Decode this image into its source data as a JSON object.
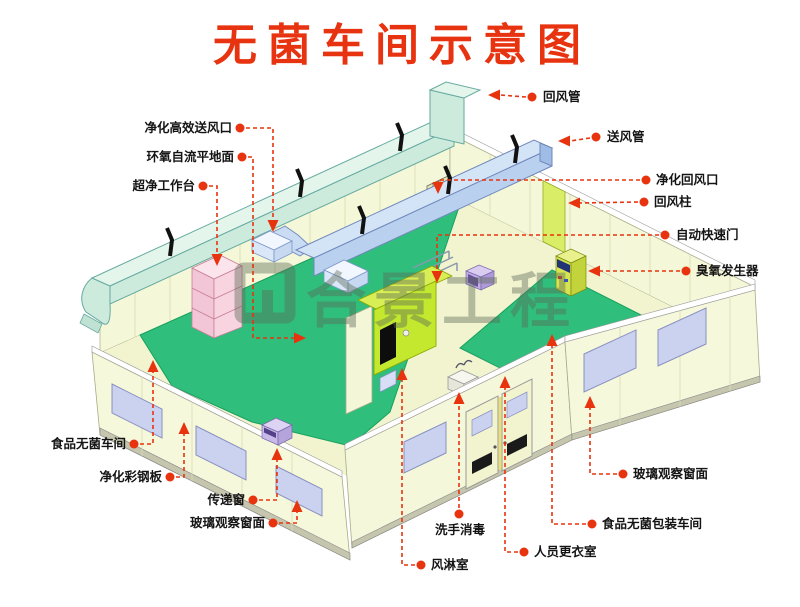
{
  "title": {
    "text": "无菌车间示意图"
  },
  "watermark": {
    "text": "合景工程"
  },
  "callouts": {
    "left": [
      {
        "id": "hepa-supply-outlet",
        "label": "净化高效送风口"
      },
      {
        "id": "epoxy-self-leveling-floor",
        "label": "环氧自流平地面"
      },
      {
        "id": "clean-workbench",
        "label": "超净工作台"
      },
      {
        "id": "food-sterile-workshop",
        "label": "食品无菌车间"
      },
      {
        "id": "purification-steel-panel",
        "label": "净化彩钢板"
      },
      {
        "id": "transfer-window",
        "label": "传递窗"
      },
      {
        "id": "glass-observation-window-left",
        "label": "玻璃观察窗面"
      }
    ],
    "right": [
      {
        "id": "return-air-duct",
        "label": "回风管"
      },
      {
        "id": "supply-air-duct",
        "label": "送风管"
      },
      {
        "id": "purification-return-outlet",
        "label": "净化回风口"
      },
      {
        "id": "return-air-column",
        "label": "回风柱"
      },
      {
        "id": "automatic-rapid-door",
        "label": "自动快速门"
      },
      {
        "id": "ozone-generator",
        "label": "臭氧发生器"
      },
      {
        "id": "glass-observation-window-right",
        "label": "玻璃观察窗面"
      },
      {
        "id": "food-sterile-packaging-workshop",
        "label": "食品无菌包装车间"
      },
      {
        "id": "staff-changing-room",
        "label": "人员更衣室"
      }
    ],
    "bottom": [
      {
        "id": "hand-wash-disinfection",
        "label": "洗手消毒"
      },
      {
        "id": "air-shower-room",
        "label": "风淋室"
      }
    ]
  },
  "colors": {
    "accent_red": "#E8330F",
    "floor_green": "#2FBE7C",
    "wall_cream": "#F6F8DC",
    "duct_cyan": "#CDEBDD",
    "duct_blue": "#B9D0EE",
    "window_lavender": "#CBD2F0",
    "air_shower_green": "#C3E82E",
    "watermark_gray": "#5C6A58"
  }
}
